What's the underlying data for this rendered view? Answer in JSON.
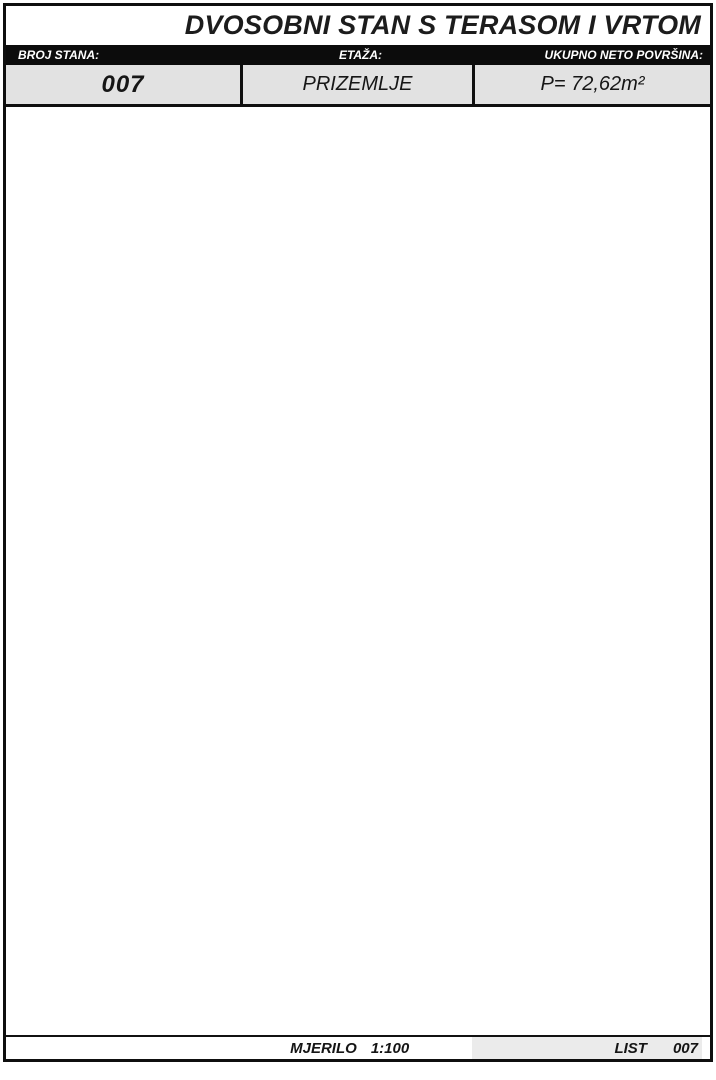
{
  "header": {
    "title": "DVOSOBNI STAN S TERASOM I VRTOM",
    "fields": [
      {
        "label": "BROJ STANA:",
        "value": "007"
      },
      {
        "label": "ETAŽA:",
        "value": "PRIZEMLJE"
      },
      {
        "label": "UKUPNO NETO POVRŠINA:",
        "value": "P= 72,62m²"
      }
    ]
  },
  "floor_plan": {
    "rooms": [
      {
        "name": "vrt",
        "area": "P=33x0.1=3,30m2"
      },
      {
        "name": "Terasa/lođa",
        "area": "P=5,55x0.2=1.11m2",
        "area2": "P=7,18x0.75=5,39m2"
      },
      {
        "name": "Soba",
        "area": "P=12,50m2"
      },
      {
        "name": "Soba",
        "area": "P=11,63m2"
      },
      {
        "name": "Dn.boravak",
        "area": "P=22,87m2"
      },
      {
        "name": "hodnik",
        "area": "P=7,78m2"
      },
      {
        "name": "kupaonica",
        "area": "P=5,79m2"
      },
      {
        "name": "WC",
        "area": "P=2,25m2"
      }
    ]
  },
  "site_plan": {
    "description": "key plan of ground floor with highlighted unit"
  },
  "footer": {
    "scale_label": "MJERILO",
    "scale_value": "1:100",
    "sheet_label": "LIST",
    "sheet_number": "007"
  },
  "colors": {
    "garden_green": "#d9e8d2",
    "plant_green": "#56a43f",
    "highlight_brown": "#9c8a72",
    "wall_black": "#141414",
    "header_gray": "#e2e2e2"
  }
}
